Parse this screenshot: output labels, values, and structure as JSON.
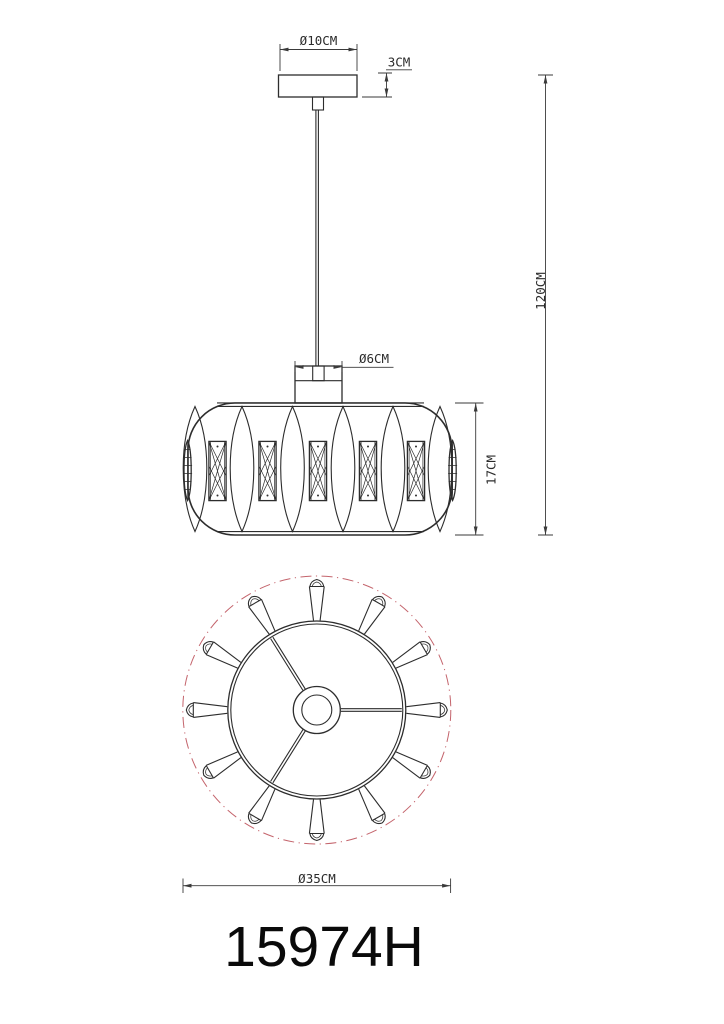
{
  "drawing": {
    "model_number": "15974H",
    "colors": {
      "line": "#2d2d2d",
      "accent_dashed_circle": "#c4646c",
      "background": "#ffffff"
    },
    "dims": {
      "canopy_diameter": "Ø10CM",
      "canopy_height": "3CM",
      "suspension_length": "120CM",
      "socket_diameter": "Ø6CM",
      "shade_height": "17CM",
      "shade_diameter": "Ø35CM"
    }
  }
}
